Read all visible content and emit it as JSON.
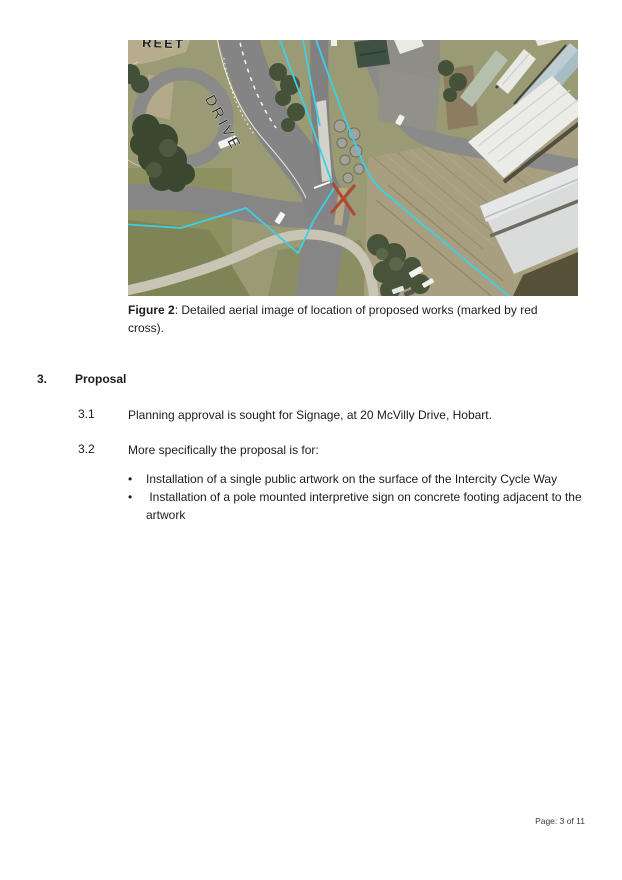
{
  "figure": {
    "caption_label": "Figure 2",
    "caption_line1": ": Detailed aerial image of location of proposed works (marked by red",
    "caption_line2": "cross).",
    "map_labels": {
      "drive": "DRIVE",
      "street_fragment": "REET"
    },
    "overlay_colors": {
      "cycleway_line": "#3ccfe9",
      "proposed_works_cross": "#ad4a31"
    }
  },
  "section": {
    "number": "3.",
    "title": "Proposal",
    "items": [
      {
        "number": "3.1",
        "text": "Planning approval is sought for Signage, at 20 McVilly Drive, Hobart."
      },
      {
        "number": "3.2",
        "text": "More specifically the proposal is for:"
      }
    ],
    "bullet_char": "•",
    "bullets": [
      "Installation of a single public artwork on the surface of the Intercity Cycle Way",
      " Installation of a pole mounted interpretive sign on concrete footing adjacent to the artwork"
    ]
  },
  "page": {
    "footer": "Page: 3 of 11"
  }
}
